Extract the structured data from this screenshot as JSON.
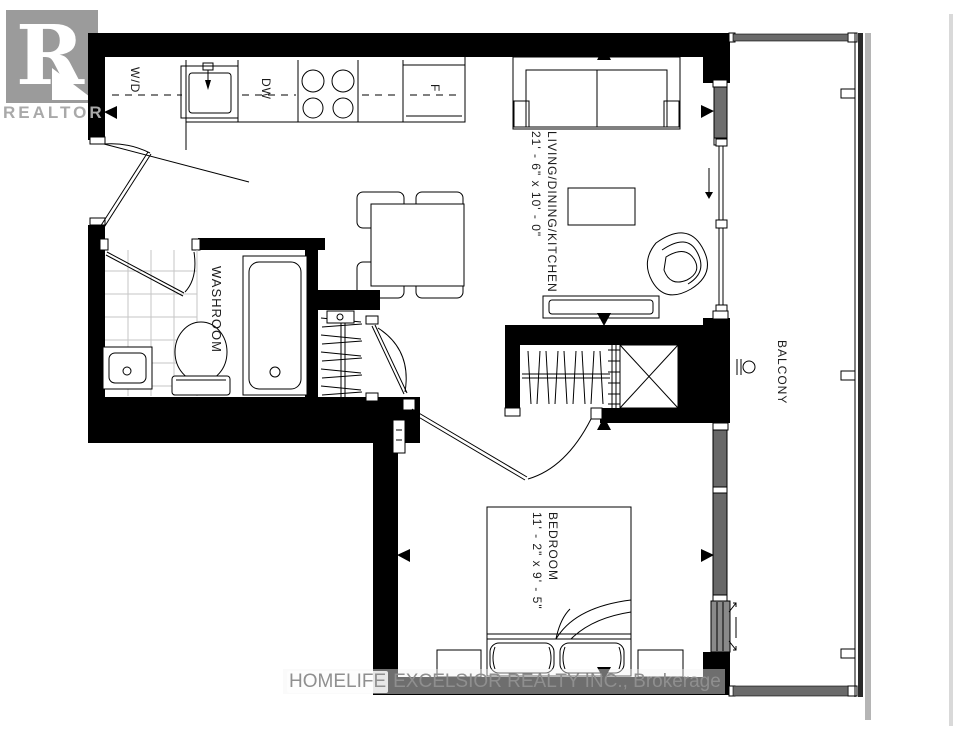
{
  "watermarks": {
    "logo_letter": "R",
    "logo_text": "REALTOR",
    "brokerage_prefix": "HOMELIFE",
    "brokerage_rest": "EXCELSIOR REALTY INC., Brokerage"
  },
  "rooms": {
    "living": {
      "label": "LIVING/DINING/KITCHEN",
      "dimensions": "21' - 6\" x 10' - 0\""
    },
    "bedroom": {
      "label": "BEDROOM",
      "dimensions": "11' - 2\" x 9' - 5\""
    },
    "washroom": {
      "label": "WASHROOM"
    },
    "balcony": {
      "label": "BALCONY"
    }
  },
  "appliances": {
    "washer_dryer": "W/D",
    "dishwasher": "DW",
    "fridge": "F"
  },
  "colors": {
    "wall": "#000000",
    "glass_door_panel": "#6e6e6e",
    "window_wall": "#686868",
    "operable_window": "#8a8a8a",
    "balcony_rail": "#6a6a6a",
    "tile_line": "#c6c6c6",
    "watermark_gray": "#9b9b9b"
  }
}
